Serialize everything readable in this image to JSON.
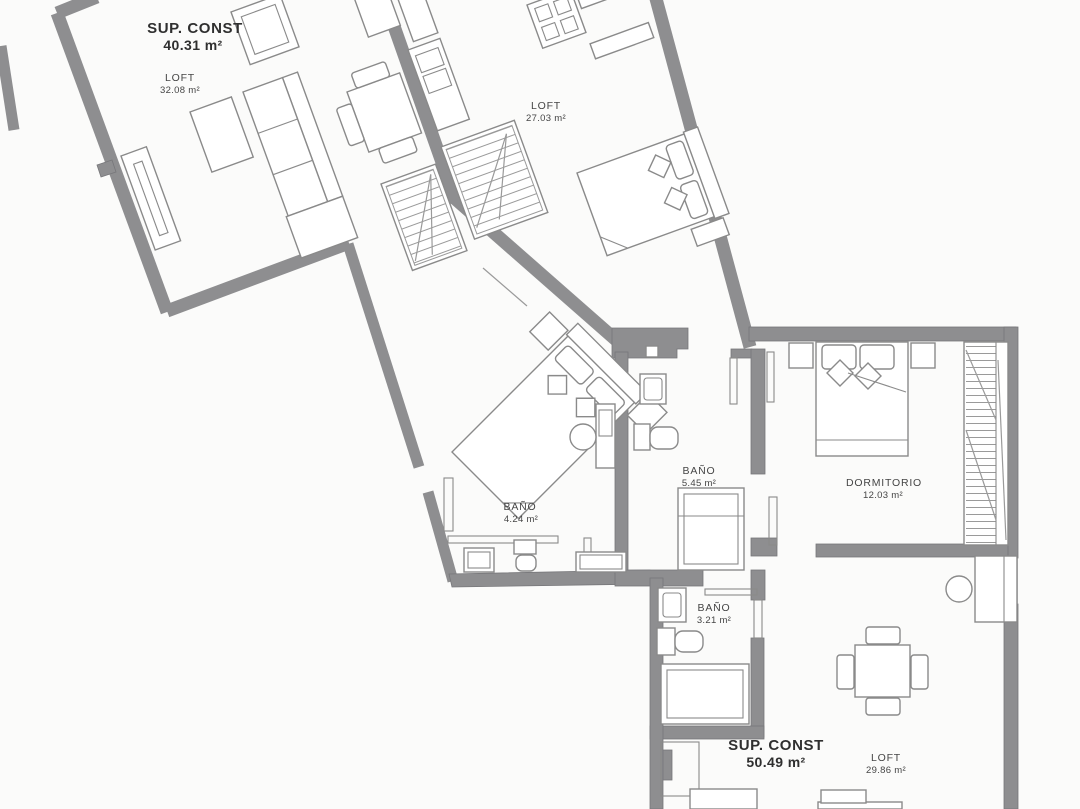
{
  "title": "Floor plan with two loft units and bedroom unit",
  "colors": {
    "wall": "#8e8e90",
    "walledge": "#77777a",
    "furniture": "#8a8a8a",
    "furniture_dark": "#6f6f6f",
    "text": "#2f2f2f",
    "text_soft": "#454545",
    "bg": "#fbfbfa"
  },
  "labels": {
    "unitA_sup": {
      "l1": "SUP. CONST",
      "l2": "40.31 m²"
    },
    "unitA_room": {
      "l1": "LOFT",
      "l2": "32.08 m²"
    },
    "unitB_room": {
      "l1": "LOFT",
      "l2": "27.03 m²"
    },
    "unitB_bath": {
      "l1": "BAÑO",
      "l2": "4.24 m²"
    },
    "bath_c": {
      "l1": "BAÑO",
      "l2": "5.45 m²"
    },
    "dorm": {
      "l1": "DORMITORIO",
      "l2": "12.03 m²"
    },
    "bath_d": {
      "l1": "BAÑO",
      "l2": "3.21 m²"
    },
    "unitC_sup": {
      "l1": "SUP. CONST",
      "l2": "50.49 m²"
    },
    "unitC_room": {
      "l1": "LOFT",
      "l2": "29.86 m²"
    }
  },
  "rooms": [
    {
      "name": "LOFT (unit A)",
      "area_m2": 32.08,
      "built_area_m2": 40.31
    },
    {
      "name": "LOFT (unit B)",
      "area_m2": 27.03
    },
    {
      "name": "BAÑO (unit B)",
      "area_m2": 4.24
    },
    {
      "name": "BAÑO (unit C upper)",
      "area_m2": 5.45
    },
    {
      "name": "DORMITORIO",
      "area_m2": 12.03
    },
    {
      "name": "BAÑO (unit C lower)",
      "area_m2": 3.21
    },
    {
      "name": "LOFT (unit C)",
      "area_m2": 29.86,
      "built_area_m2": 50.49
    }
  ]
}
